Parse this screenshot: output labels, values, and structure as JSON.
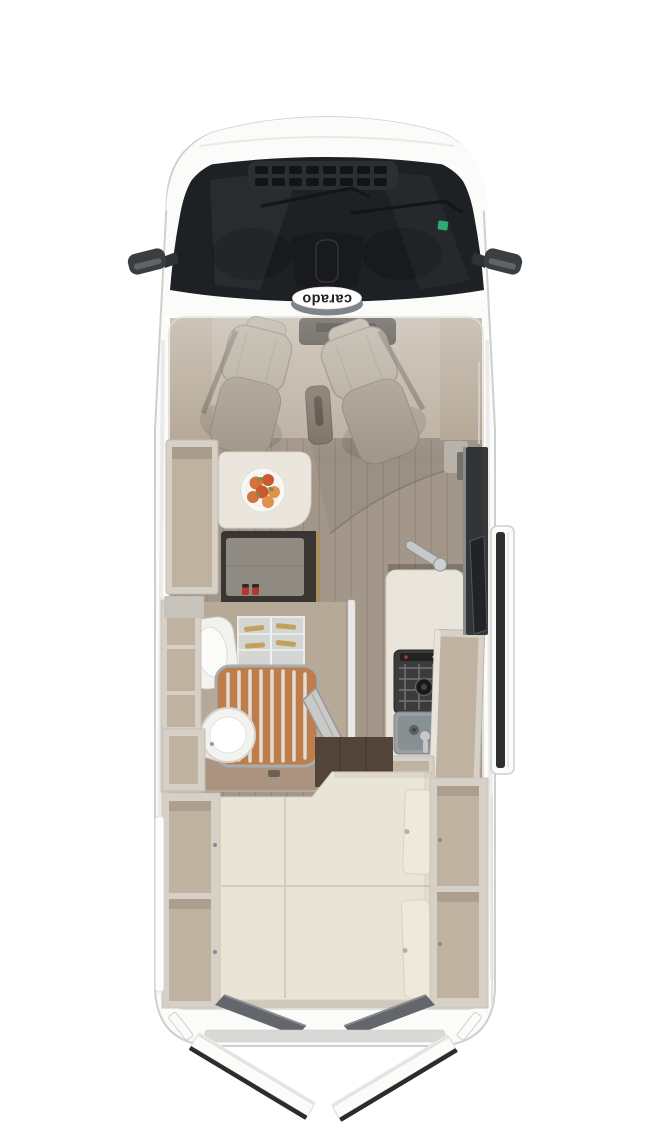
{
  "brand": {
    "logo_text": "carado"
  },
  "scene": {
    "description_label": "camper-van-floorplan-top-view"
  },
  "colors": {
    "bg": "#ffffff",
    "body": "#fbfbfa",
    "body_outline": "#cfcfcd",
    "body_shade": "#e9e9e7",
    "glass": "#1e2124",
    "grille_base": "#2c2f31",
    "grille_slot": "#121415",
    "wiper": "#141517",
    "sticker_green": "#2fa874",
    "mirror": "#3b3e41",
    "mirror_hi": "#6b6e71",
    "logo_swoosh": "#7e8487",
    "logo_text": "#1f2225",
    "wall_edge": "#d4d1ca",
    "cab_wall": "#b3a593",
    "cab_floor": "#bcb0a1",
    "dash": "#4a443c",
    "seat_fabric": "#b2a999",
    "seat_edge": "#948b7c",
    "seat_base": "#a2988a",
    "console": "#7d7265",
    "wood": "#a3978a",
    "wood_plank": "#8c8073",
    "table": "#eae6de",
    "plate": "#f7f7f4",
    "fruit_1": "#d4743c",
    "fruit_2": "#c95a30",
    "fruit_3": "#e0914e",
    "leaf": "#76923f",
    "bench_frame": "#393632",
    "bench_cushion": "#8f8b83",
    "buckle_red": "#b5372a",
    "trim_brass": "#a98e5f",
    "cabinet_face": "#d6d0c7",
    "cabinet_inner": "#c0b2a1",
    "bath_floor": "#b7a997",
    "bath_wood": "#aa9480",
    "fixture": "#f2f2ef",
    "fixture_edge": "#d5d4d0",
    "shower_wood": "#bd7e4c",
    "shower_slat": "#e6e5e1",
    "shower_rim": "#a7acae",
    "shower_door": "#c9c9c7",
    "glass_shelf": "#d7dbd9",
    "glass_amber": "#c3a05c",
    "counter": "#eae5da",
    "steel": "#c6c8ca",
    "steel_edge": "#8e9092",
    "hob": "#3b3b3b",
    "hob_grid": "#757575",
    "sink": "#9b9fa1",
    "door_dark": "#2c2e30",
    "dark_floor": "#53443a",
    "bed": "#eae4d6",
    "bed_seam": "#d3cbbb",
    "bed_cushion": "#efe9db",
    "rear_panel": "#63666a",
    "rear_panel_2": "#8a8d90",
    "sill": "#d9d9d7"
  }
}
